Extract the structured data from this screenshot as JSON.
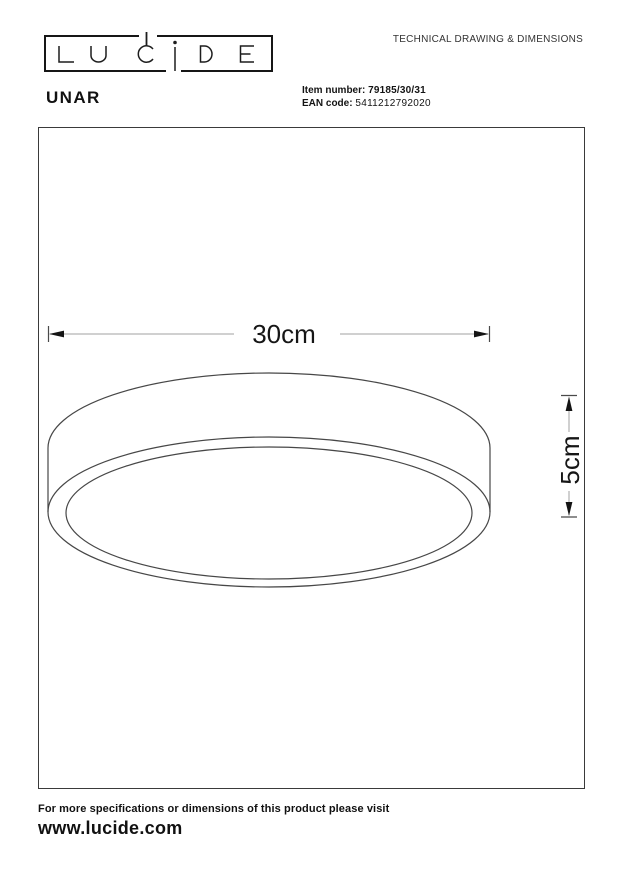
{
  "header": {
    "logo_text": "LUCiDE",
    "title": "TECHNICAL DRAWING & DIMENSIONS"
  },
  "product": {
    "name": "UNAR",
    "item_label": "Item number:",
    "item_value": "79185/30/31",
    "ean_label": "EAN code:",
    "ean_value": "5411212792020"
  },
  "drawing": {
    "type": "technical-line-drawing",
    "subject": "round drum ceiling light shown in oblique view from below",
    "dimensions": [
      {
        "label": "30cm",
        "axis": "horizontal",
        "measures": "diameter"
      },
      {
        "label": "5cm",
        "axis": "vertical",
        "measures": "height"
      }
    ]
  },
  "footer": {
    "note": "For more specifications or dimensions of this product please visit",
    "website": "www.lucide.com"
  },
  "colors": {
    "ink": "#1a1a1a",
    "drawing_line": "#474747",
    "dimension_line": "#a2a2a2",
    "dimension_ends": "#141414",
    "background": "#ffffff"
  }
}
